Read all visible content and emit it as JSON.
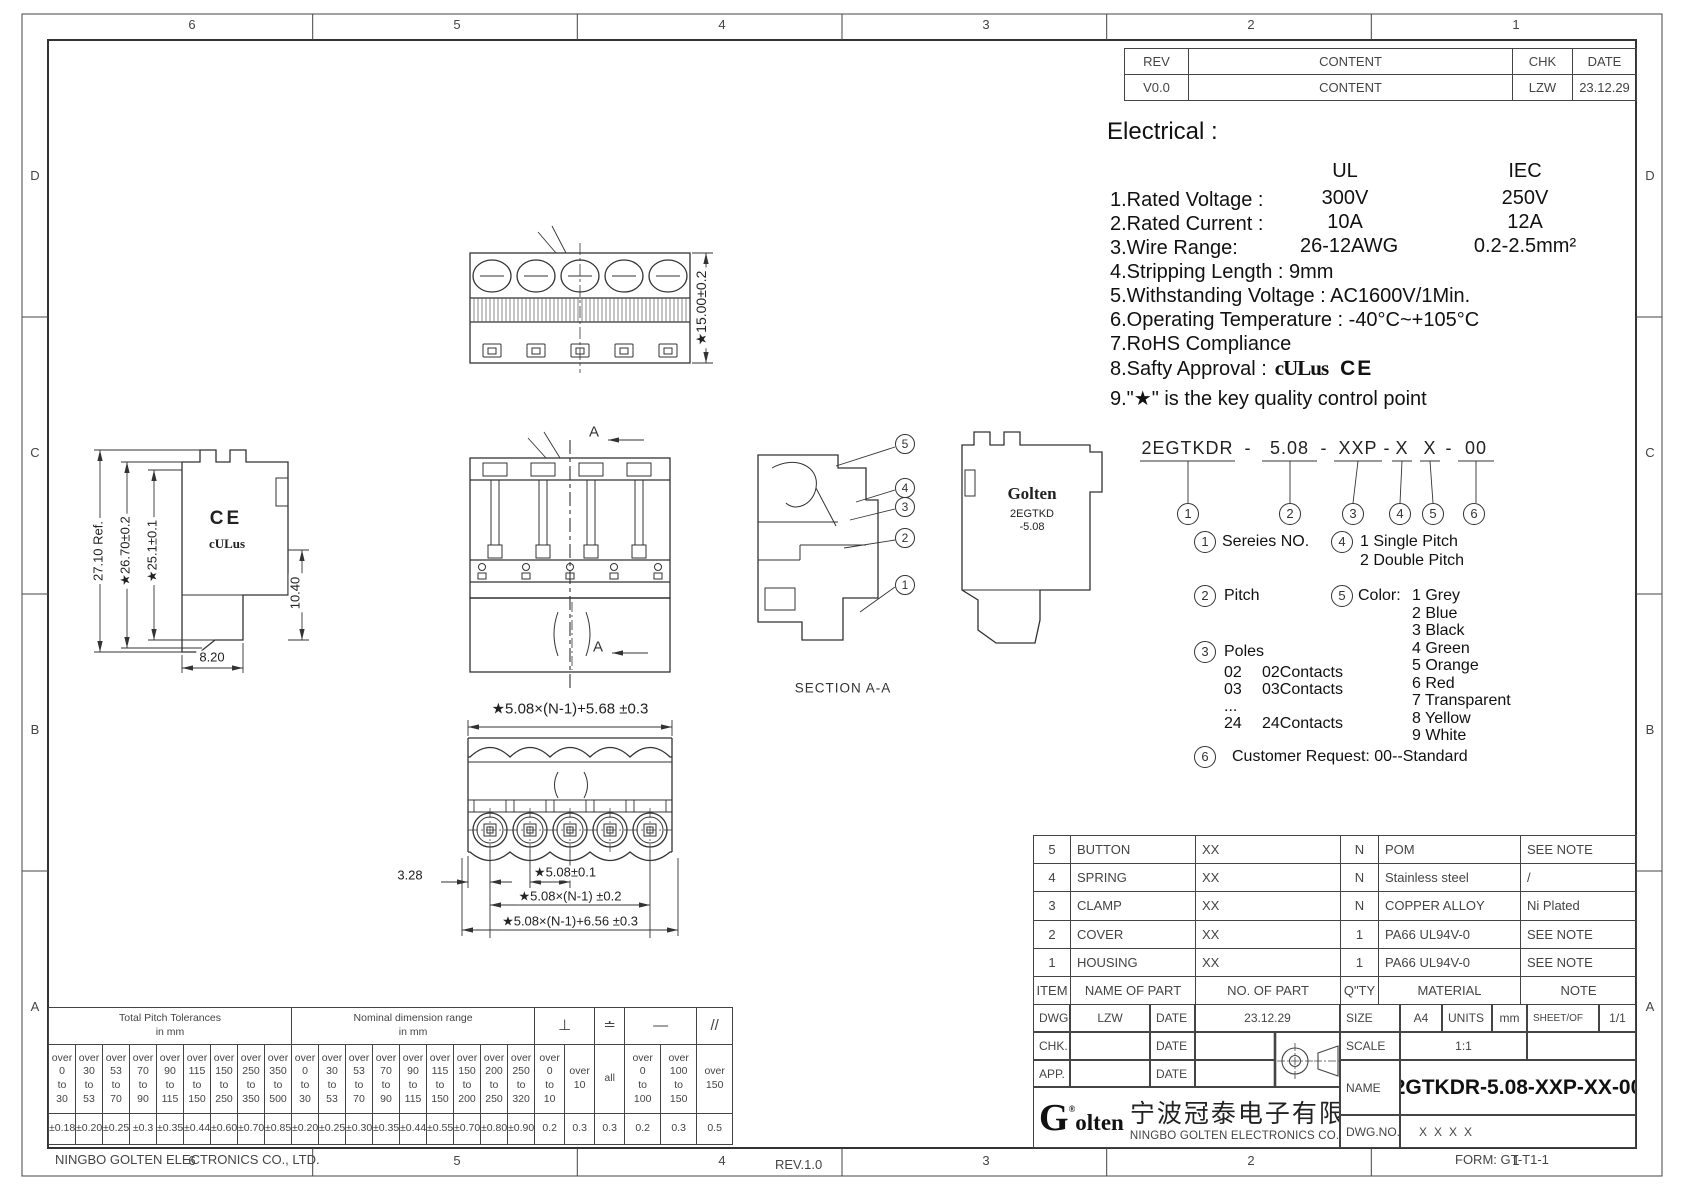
{
  "sheet": {
    "zones_h": [
      "6",
      "5",
      "4",
      "3",
      "2",
      "1"
    ],
    "zones_v": [
      "D",
      "C",
      "B",
      "A"
    ],
    "footer": {
      "company": "NINGBO GOLTEN ELECTRONICS CO., LTD.",
      "rev": "REV.1.0",
      "form": "FORM: GT-T1-1"
    }
  },
  "revision_table": {
    "headers": {
      "rev": "REV",
      "content": "CONTENT",
      "chk": "CHK",
      "date": "DATE"
    },
    "row": {
      "rev": "V0.0",
      "content": "CONTENT",
      "chk": "LZW",
      "date": "23.12.29"
    }
  },
  "electrical": {
    "title": "Electrical :",
    "col_ul": "UL",
    "col_iec": "IEC",
    "rows": [
      {
        "label": "1.Rated Voltage :",
        "ul": "300V",
        "iec": "250V"
      },
      {
        "label": "2.Rated Current :",
        "ul": "10A",
        "iec": "12A"
      },
      {
        "label": "3.Wire Range:",
        "ul": "26-12AWG",
        "iec": "0.2-2.5mm²"
      }
    ],
    "lines": [
      "4.Stripping Length : 9mm",
      "5.Withstanding Voltage : AC1600V/1Min.",
      "6.Operating Temperature : -40°C~+105°C",
      "7.RoHS Compliance"
    ],
    "approval_line": "8.Safty Approval :",
    "ul_mark": "cULus",
    "ce_mark": "CE",
    "quality_line": "9.\"★\" is the key quality control point"
  },
  "part_number": {
    "segments": [
      "2EGTKDR",
      "-",
      "5.08",
      "-",
      "XXP",
      "-",
      "X",
      "X",
      "-",
      "00"
    ],
    "callouts": [
      "1",
      "2",
      "3",
      "4",
      "5",
      "6"
    ],
    "legend1_label": "Sereies NO.",
    "legend2_label": "Pitch",
    "legend3_label": "Poles",
    "poles": [
      [
        "02",
        "02Contacts"
      ],
      [
        "03",
        "03Contacts"
      ],
      [
        "...",
        ""
      ],
      [
        "24",
        "24Contacts"
      ]
    ],
    "legend4_lines": [
      "1  Single Pitch",
      "2  Double Pitch"
    ],
    "legend5_label": "Color:",
    "colors": [
      "1 Grey",
      "2 Blue",
      "3 Black",
      "4 Green",
      "5 Orange",
      "6 Red",
      "7 Transparent",
      "8 Yellow",
      "9 White"
    ],
    "legend6_label": "Customer Request: 00--Standard"
  },
  "parts_table": {
    "header": {
      "item": "ITEM",
      "name": "NAME OF PART",
      "no": "NO. OF PART",
      "qty": "Q\"TY",
      "material": "MATERIAL",
      "note": "NOTE"
    },
    "rows": [
      {
        "item": "5",
        "name": "BUTTON",
        "no": "XX",
        "qty": "N",
        "material": "POM",
        "note": "SEE NOTE"
      },
      {
        "item": "4",
        "name": "SPRING",
        "no": "XX",
        "qty": "N",
        "material": "Stainless steel",
        "note": "/"
      },
      {
        "item": "3",
        "name": "CLAMP",
        "no": "XX",
        "qty": "N",
        "material": "COPPER ALLOY",
        "note": "Ni Plated"
      },
      {
        "item": "2",
        "name": "COVER",
        "no": "XX",
        "qty": "1",
        "material": "PA66 UL94V-0",
        "note": "SEE NOTE"
      },
      {
        "item": "1",
        "name": "HOUSING",
        "no": "XX",
        "qty": "1",
        "material": "PA66 UL94V-0",
        "note": "SEE NOTE"
      }
    ]
  },
  "title_block": {
    "dwg": "DWG.",
    "dwg_by": "LZW",
    "date": "DATE",
    "dwg_date": "23.12.29",
    "chk": "CHK.",
    "app": "APP.",
    "size": "SIZE",
    "size_v": "A4",
    "units": "UNITS",
    "units_v": "mm",
    "sheet": "SHEET/OF",
    "sheet_v": "1/1",
    "scale": "SCALE",
    "scale_v": "1:1",
    "name": "NAME",
    "name_v": "2GTKDR-5.08-XXP-XX-00",
    "dwgno": "DWG.NO.",
    "dwgno_v": "XXXX",
    "logo_g": "G",
    "logo_reg": "®",
    "logo_rest": "olten",
    "company_cn": "宁波冠泰电子有限公司",
    "company_en": "NINGBO GOLTEN ELECTRONICS CO., LTD."
  },
  "tolerance_table": {
    "pitch_title": "Total Pitch Tolerances",
    "pitch_unit": "in mm",
    "nominal_title": "Nominal dimension range",
    "nominal_unit": "in mm",
    "pitch_cols": [
      {
        "over": "0",
        "to": "30",
        "tol": "±0.18"
      },
      {
        "over": "30",
        "to": "53",
        "tol": "±0.20"
      },
      {
        "over": "53",
        "to": "70",
        "tol": "±0.25"
      },
      {
        "over": "70",
        "to": "90",
        "tol": "±0.3"
      },
      {
        "over": "90",
        "to": "115",
        "tol": "±0.35"
      },
      {
        "over": "115",
        "to": "150",
        "tol": "±0.44"
      },
      {
        "over": "150",
        "to": "250",
        "tol": "±0.60"
      },
      {
        "over": "250",
        "to": "350",
        "tol": "±0.70"
      },
      {
        "over": "350",
        "to": "500",
        "tol": "±0.85"
      }
    ],
    "nominal_cols": [
      {
        "over": "0",
        "to": "30",
        "tol": "±0.20"
      },
      {
        "over": "30",
        "to": "53",
        "tol": "±0.25"
      },
      {
        "over": "53",
        "to": "70",
        "tol": "±0.30"
      },
      {
        "over": "70",
        "to": "90",
        "tol": "±0.35"
      },
      {
        "over": "90",
        "to": "115",
        "tol": "±0.44"
      },
      {
        "over": "115",
        "to": "150",
        "tol": "±0.55"
      },
      {
        "over": "150",
        "to": "200",
        "tol": "±0.70"
      },
      {
        "over": "200",
        "to": "250",
        "tol": "±0.80"
      },
      {
        "over": "250",
        "to": "320",
        "tol": "±0.90"
      }
    ],
    "geo_sections": [
      {
        "symbol": "⊥",
        "name": "perpendicularity",
        "cols": [
          {
            "over": "0",
            "to": "10",
            "tol": "0.2"
          },
          {
            "over": "10",
            "to": "",
            "tol": "0.3"
          }
        ]
      },
      {
        "symbol": "≐",
        "name": "parallel-plane",
        "cols": [
          {
            "over": "all",
            "to": "",
            "tol": "0.3"
          }
        ]
      },
      {
        "symbol": "—",
        "name": "straightness",
        "cols": [
          {
            "over": "0",
            "to": "100",
            "tol": "0.2"
          },
          {
            "over": "100",
            "to": "150",
            "tol": "0.3"
          }
        ]
      },
      {
        "symbol": "//",
        "name": "parallelism",
        "cols": [
          {
            "over": "150",
            "to": "",
            "tol": "0.5"
          }
        ]
      }
    ]
  },
  "views": {
    "top_view": {
      "dim_height": "★15.00±0.2"
    },
    "side_view": {
      "dim_ref": "27.10 Ref.",
      "dim_a": "★26.70±0.2",
      "dim_b": "★25.1±0.1",
      "dim_c": "10.40",
      "dim_d": "8.20",
      "ce": "CE",
      "ul": "cULus"
    },
    "front_view": {
      "marker": "A"
    },
    "section_view": {
      "label": "SECTION A-A",
      "balloons": [
        "5",
        "4",
        "3",
        "2",
        "1"
      ]
    },
    "side_view2": {
      "logo": "Golten",
      "line1": "2EGTKD",
      "line2": "-5.08"
    },
    "bottom_view": {
      "dim_top": "★5.08×(N-1)+5.68 ±0.3",
      "dim_left": "3.28",
      "dim_pitch": "★5.08±0.1",
      "dim_span": "★5.08×(N-1) ±0.2",
      "dim_overall": "★5.08×(N-1)+6.56 ±0.3"
    }
  }
}
